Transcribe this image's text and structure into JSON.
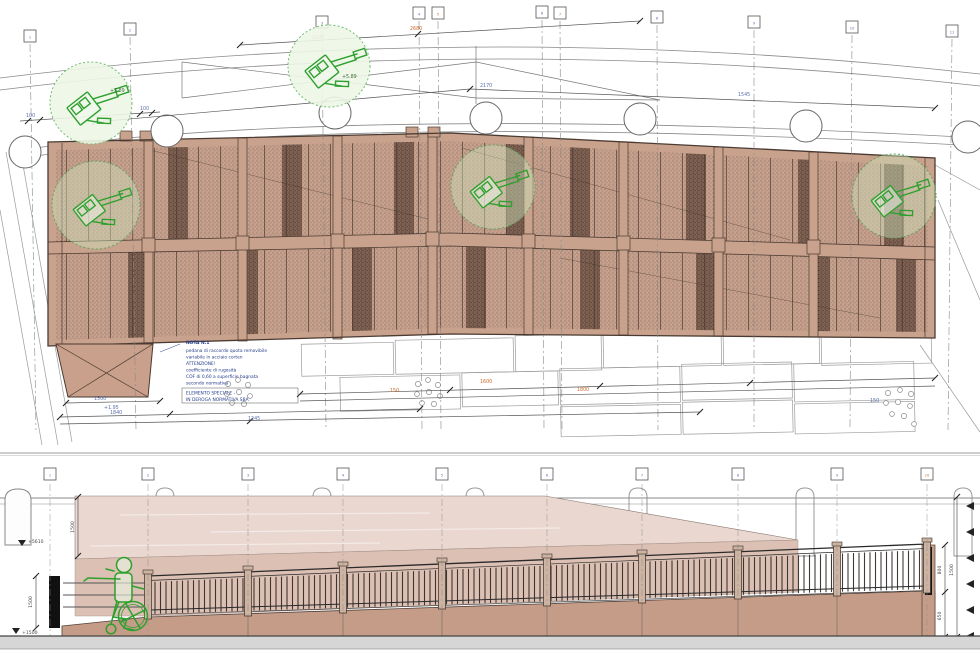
{
  "drawing": {
    "type": "technical-plan-and-elevation",
    "colors": {
      "panel_light": "#c7a18e",
      "panel_dark": "#7e6152",
      "frame_tan": "#c9a28d",
      "wall_brown": "#c59c88",
      "pale_deck": "#e9d7d0",
      "mid_deck": "#dcc0b4",
      "green_symbol": "#2da02d",
      "dim_blue": "#5b6fae",
      "dim_orange": "#c8682a",
      "note_navy": "#27408b",
      "ground_gray": "#d6d6d6"
    }
  },
  "plan": {
    "grid_labels": [
      "1",
      "2",
      "3",
      "4",
      "5",
      "6",
      "7",
      "8",
      "9",
      "10",
      "11"
    ],
    "dims": [
      {
        "text": "1500"
      },
      {
        "text": "2680"
      },
      {
        "text": "2170"
      },
      {
        "text": "1545"
      },
      {
        "text": "100"
      },
      {
        "text": "100"
      },
      {
        "text": "1500"
      },
      {
        "text": "1840"
      },
      {
        "text": "1245"
      },
      {
        "text": "1600"
      },
      {
        "text": "1800"
      },
      {
        "text": "150"
      },
      {
        "text": "150"
      },
      {
        "text": "+1.95"
      }
    ],
    "levels": [
      {
        "text": "+5.89"
      },
      {
        "text": "+5.89"
      }
    ],
    "note": {
      "title": "NOTA N.1",
      "lines": [
        "pedana di raccordo quota removibile",
        "variabile in acciaio corten",
        "ATTENZIONE!",
        "coefficiente di rugosità",
        "COF di 0,60 a superficie bagnata",
        "secondo normativa"
      ],
      "special_line1": "ELEMENTO SPECIALE -",
      "special_line2": "IN DEROGA NORMATIVA SBA"
    },
    "icons": {
      "equipment": "boom-lift-plan-icon",
      "tree": "tree-circle-icon"
    }
  },
  "elevation": {
    "grid_labels": [
      "1",
      "2",
      "3",
      "4",
      "5",
      "6",
      "7",
      "8",
      "9",
      "10"
    ],
    "dims": [
      {
        "text": "1500"
      },
      {
        "text": "1500"
      },
      {
        "text": "800"
      },
      {
        "text": "650"
      },
      {
        "text": "1500"
      }
    ],
    "levels": [
      {
        "text": "+5610"
      },
      {
        "text": "+1500"
      }
    ],
    "icons": {
      "wheelchair": "wheelchair-user-icon",
      "bollard": "bollard-icon"
    }
  }
}
